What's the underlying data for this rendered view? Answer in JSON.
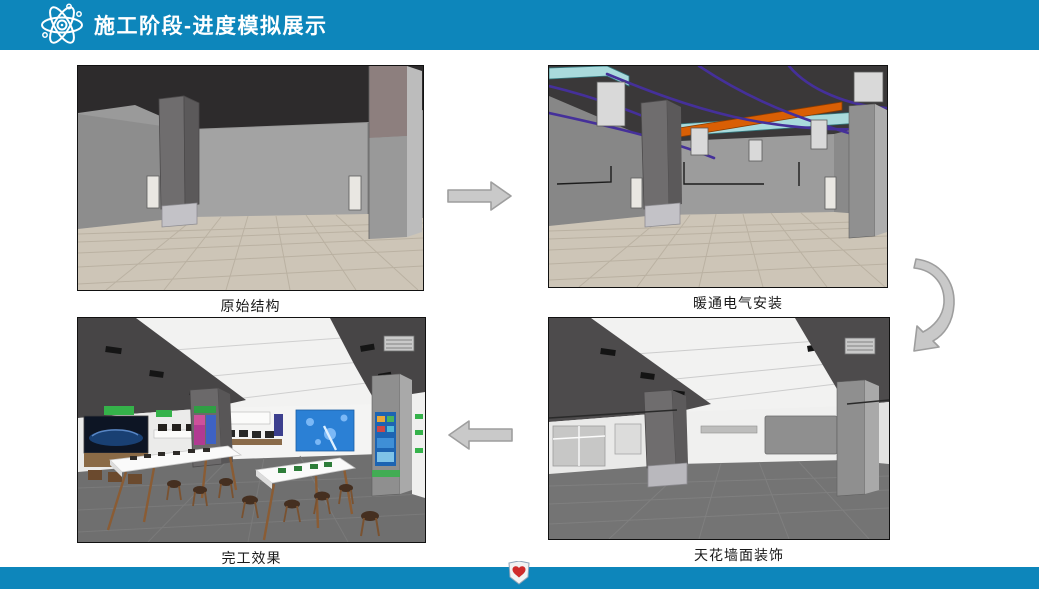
{
  "header": {
    "title": "施工阶段-进度模拟展示",
    "icon": "atom-icon"
  },
  "stages": [
    {
      "id": "original-structure",
      "label": "原始结构",
      "position": "top-left"
    },
    {
      "id": "hvac-electrical-install",
      "label": "暖通电气安装",
      "position": "top-right"
    },
    {
      "id": "ceiling-wall-decoration",
      "label": "天花墙面装饰",
      "position": "bottom-right"
    },
    {
      "id": "finished-effect",
      "label": "完工效果",
      "position": "bottom-left"
    }
  ],
  "arrows": [
    {
      "id": "arrow-right-icon",
      "direction": "right",
      "from": "原始结构",
      "to": "暖通电气安装"
    },
    {
      "id": "arrow-curved-down-icon",
      "direction": "down",
      "from": "暖通电气安装",
      "to": "天花墙面装饰"
    },
    {
      "id": "arrow-left-icon",
      "direction": "left",
      "from": "天花墙面装饰",
      "to": "完工效果"
    }
  ],
  "footer": {
    "logo": "shield-heart-logo-icon"
  },
  "colors": {
    "header-bg": "#0d86bb",
    "footer-bg": "#0d86bb",
    "title-color": "#ffffff",
    "caption-color": "#1a1a1a",
    "arrow-fill": "#c9c9c9",
    "arrow-stroke": "#9e9e9e"
  }
}
